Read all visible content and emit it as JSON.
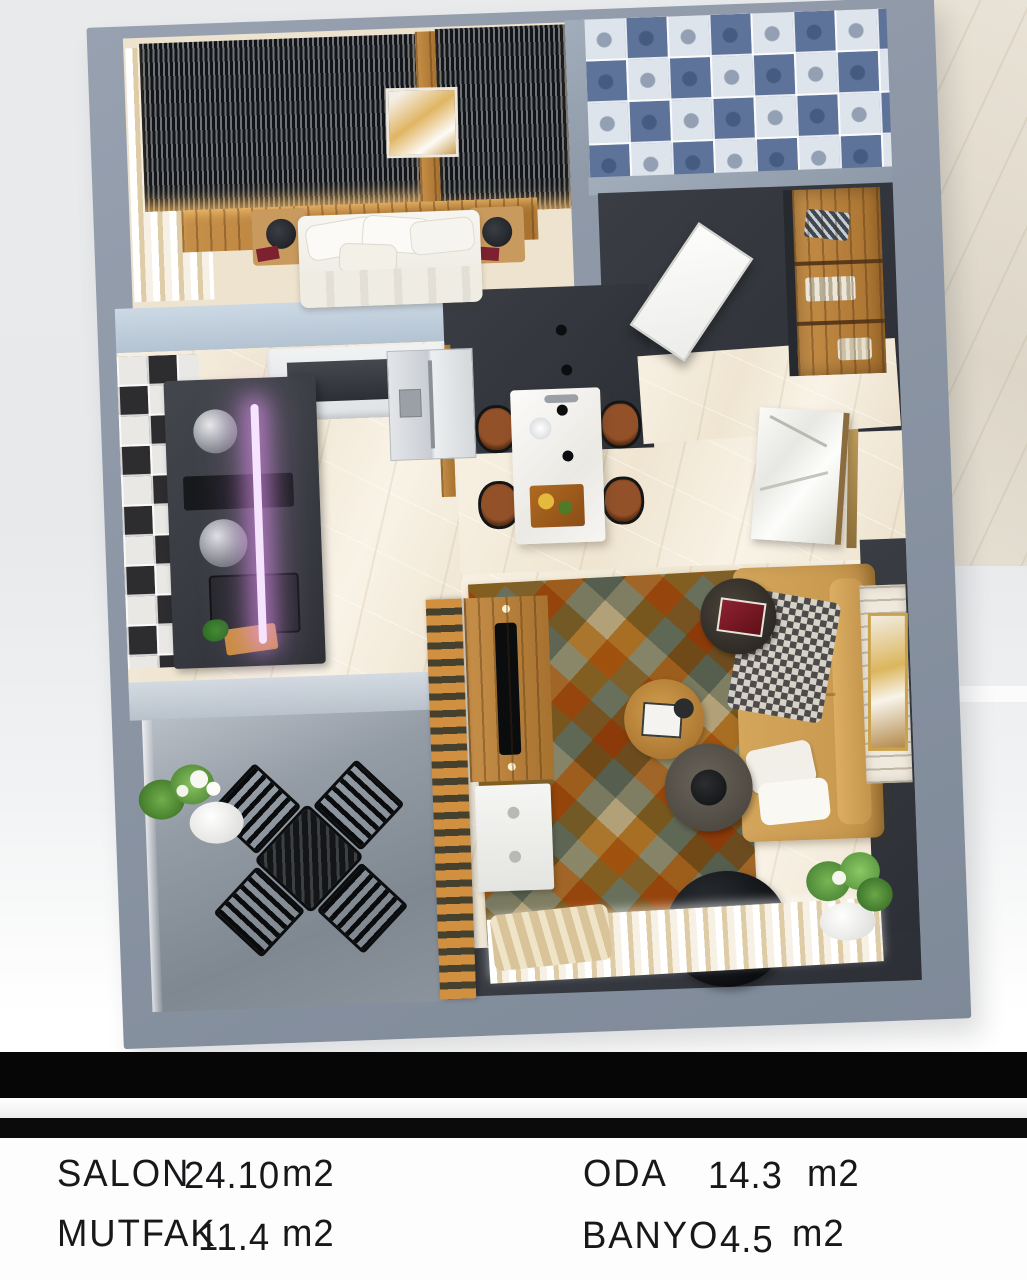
{
  "legend": {
    "items": [
      {
        "name": "SALON",
        "area": "24.10",
        "unit": "m2"
      },
      {
        "name": "ODA",
        "area": "14.3",
        "unit": "m2"
      },
      {
        "name": "MUTFAK",
        "area": "11.4",
        "unit": "m2"
      },
      {
        "name": "BANYO",
        "area": "4.5",
        "unit": "m2"
      }
    ]
  },
  "plan": {
    "colors": {
      "outer_wall": "#8b95a4",
      "interior_dark_wall": "#33373d",
      "floor_marble": "#f2e9da",
      "wood_accent": "#b5783c",
      "sofa": "#cfa055",
      "rug_orange": "#d6993c",
      "bathroom_tile_blue": "#5e7399",
      "balcony_floor": "#8a929b",
      "led_accent": "#efb9ff"
    }
  }
}
